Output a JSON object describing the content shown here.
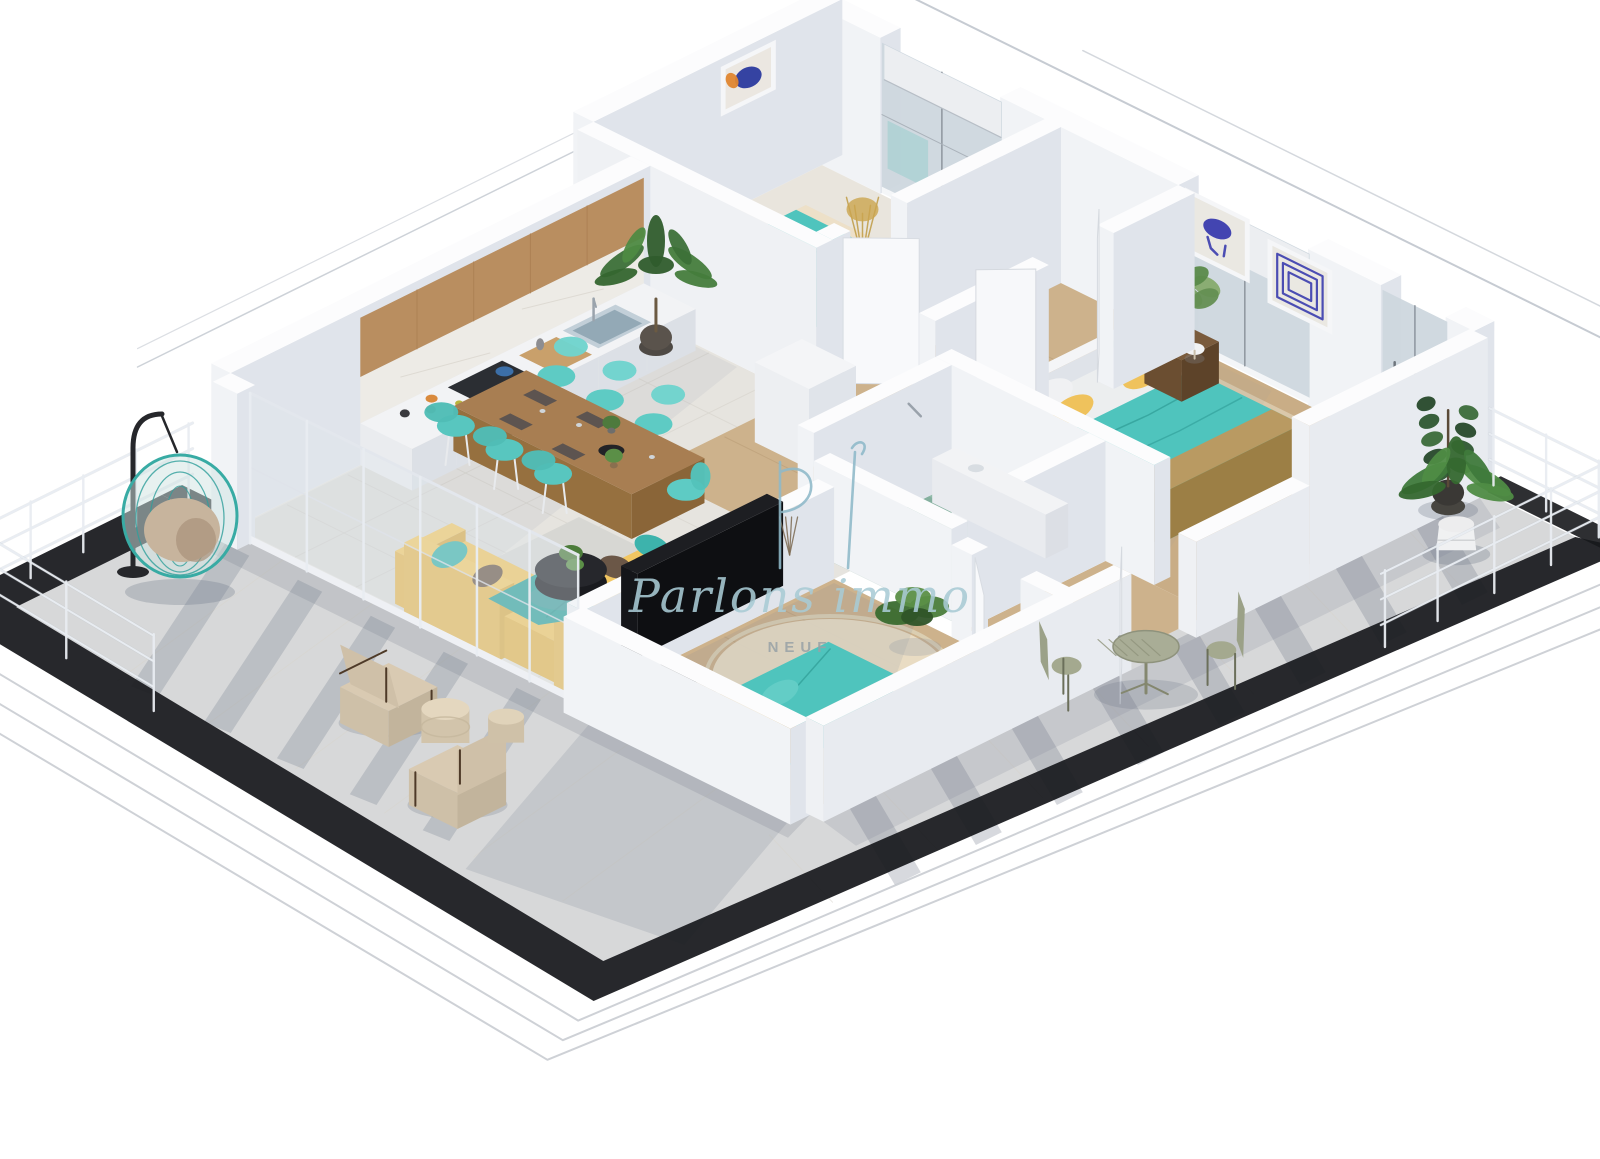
{
  "image_type": "3d-floorplan-render",
  "watermark": {
    "monogram": "PI",
    "brand": "Parlons immo",
    "label": "NEUF",
    "monogram_color": "#8fb9c9",
    "brand_color": "#a9cbd5",
    "label_color": "#9aa3a7"
  },
  "palette": {
    "bg": "#ffffff",
    "wallTop": "#fcfcfd",
    "wallLight": "#f1f3f6",
    "wallShade": "#e0e4eb",
    "tile": "#e6e4df",
    "tileLine": "#d8d5ce",
    "wood": "#cdb28c",
    "wood2": "#c9ad86",
    "plank": "#b79a73",
    "bath": "#92bcaa",
    "bathDark": "#6d9a8d",
    "rug": "#ecdfc7",
    "rugRound": "#e9ddc5",
    "rugGray": "#d6d6d2",
    "rugMaster": "#dbcbae",
    "teal": "#4fc4bd",
    "tealDark": "#38aba4",
    "tealLight": "#63cdc6",
    "yellow": "#f1c662",
    "yellowDeep": "#d8a942",
    "mustard": "#c99a3f",
    "tableWood": "#a87e52",
    "darkWood": "#7a5b3c",
    "black": "#1c1d21",
    "terrace": "#d7d8d9",
    "shadow": "#6e7888",
    "edge": "#17181c",
    "step": "#c2c6cc",
    "rail": "#e9edf2",
    "railDark": "#b9bfc8",
    "glass": "#cdd7de",
    "artBlue": "#3a3cae",
    "artOrange": "#e0862f",
    "green": "#3f7a3c",
    "greenDark": "#2e5730",
    "greenLight": "#4f8c45",
    "beige": "#d9cab2",
    "beigeDark": "#cfc0a8",
    "sage": "#a9ad96",
    "sageDark": "#8e927c",
    "basket": "#b49d76",
    "cushion": "#c7b49d"
  },
  "scene": {
    "style": "isometric cutaway apartment render on white background",
    "rooms": [
      "kitchen-living",
      "bedroom-1",
      "hallway",
      "bathroom",
      "master-bedroom",
      "small-bedroom",
      "wrap-around-terrace"
    ],
    "furnishings": [
      "white-kitchen-with-wood-upper-cabinets",
      "wood-dining-table-six-teal-chairs",
      "yellow-corner-sofa-teal-pillows",
      "black-tv-sideboard",
      "teal-and-yellow-double-bed",
      "single-teal-bed",
      "teal-hanging-egg-chair",
      "two-beige-terrace-armchairs",
      "sage-bistro-set",
      "potted-plants",
      "laundry-basket",
      "blue-abstract-wall-art"
    ]
  }
}
